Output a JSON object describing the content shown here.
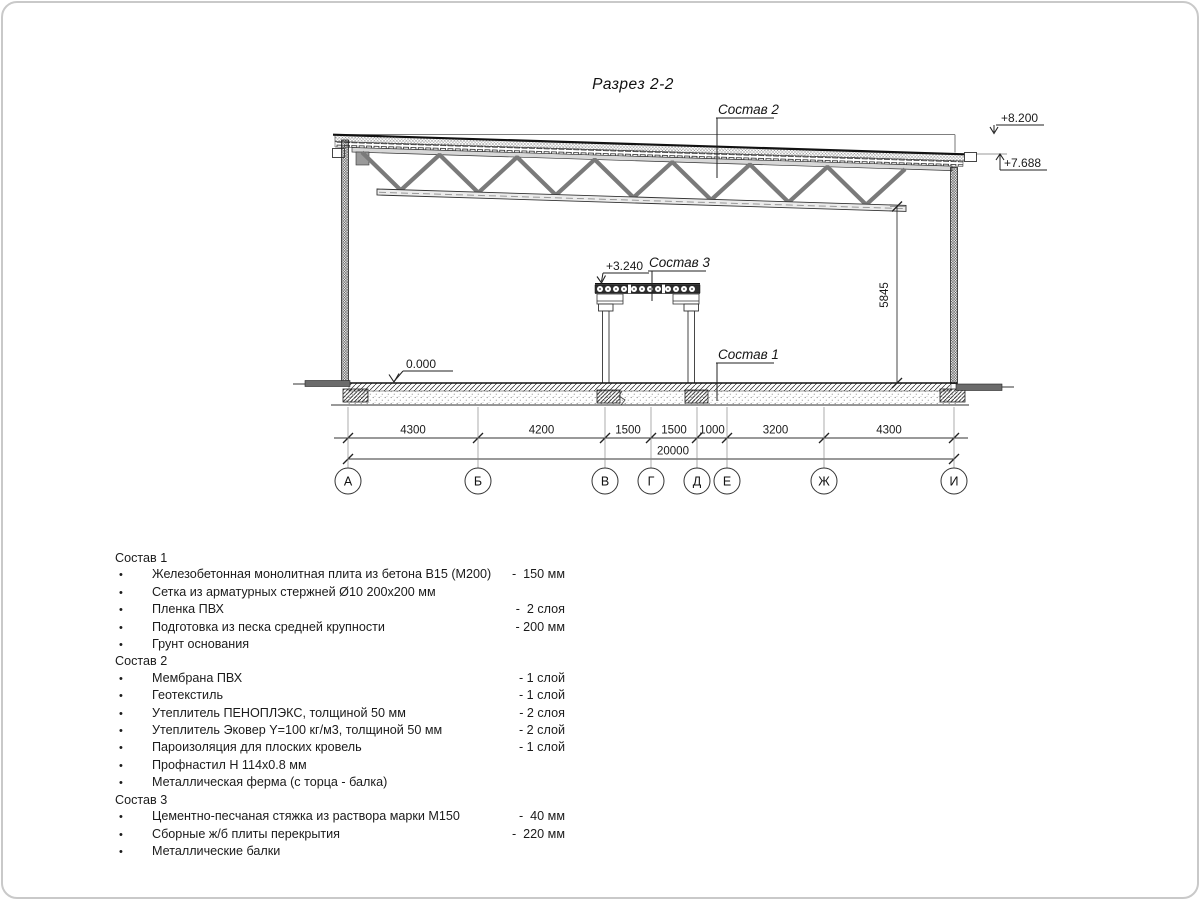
{
  "drawing": {
    "title": "Разрез 2-2",
    "callouts": {
      "c1": "Состав 1",
      "c2": "Состав 2",
      "c3": "Состав 3"
    },
    "elevations": {
      "roof_high": "+8.200",
      "roof_low": "+7.688",
      "platform": "+3.240",
      "floor": "0.000"
    },
    "dim_height": "5845",
    "axes": [
      "А",
      "Б",
      "В",
      "Г",
      "Д",
      "Е",
      "Ж",
      "И"
    ],
    "dims": [
      "4300",
      "4200",
      "1500",
      "1500",
      "1000",
      "3200",
      "4300"
    ],
    "dim_total": "20000"
  },
  "legend": {
    "bullet": "•",
    "sections": [
      {
        "title": "Состав 1",
        "items": [
          {
            "text": "Железобетонная монолитная плита из бетона В15 (М200)",
            "value": "-  150 мм"
          },
          {
            "text": "Сетка из арматурных стержней Ø10 200x200 мм",
            "value": ""
          },
          {
            "text": "Пленка ПВХ",
            "value": "-  2 слоя"
          },
          {
            "text": "Подготовка из песка средней крупности",
            "value": "- 200 мм"
          },
          {
            "text": "Грунт основания",
            "value": ""
          }
        ]
      },
      {
        "title": "Состав 2",
        "items": [
          {
            "text": "Мембрана ПВХ",
            "value": "- 1 слой"
          },
          {
            "text": "Геотекстиль",
            "value": "- 1 слой"
          },
          {
            "text": "Утеплитель ПЕНОПЛЭКС, толщиной 50 мм",
            "value": "- 2 слоя"
          },
          {
            "text": "Утеплитель Эковер Y=100 кг/м3, толщиной 50 мм",
            "value": "- 2 слой"
          },
          {
            "text": "Пароизоляция для плоских кровель",
            "value": "- 1 слой"
          },
          {
            "text": "Профнастил Н 114х0.8 мм",
            "value": ""
          },
          {
            "text": "Металлическая ферма (с торца - балка)",
            "value": ""
          }
        ]
      },
      {
        "title": "Состав 3",
        "items": [
          {
            "text": "Цементно-песчаная стяжка из раствора марки М150",
            "value": "-  40 мм"
          },
          {
            "text": "Сборные ж/б плиты перекрытия",
            "value": "-  220 мм"
          },
          {
            "text": "Металлические балки",
            "value": ""
          }
        ]
      }
    ]
  }
}
